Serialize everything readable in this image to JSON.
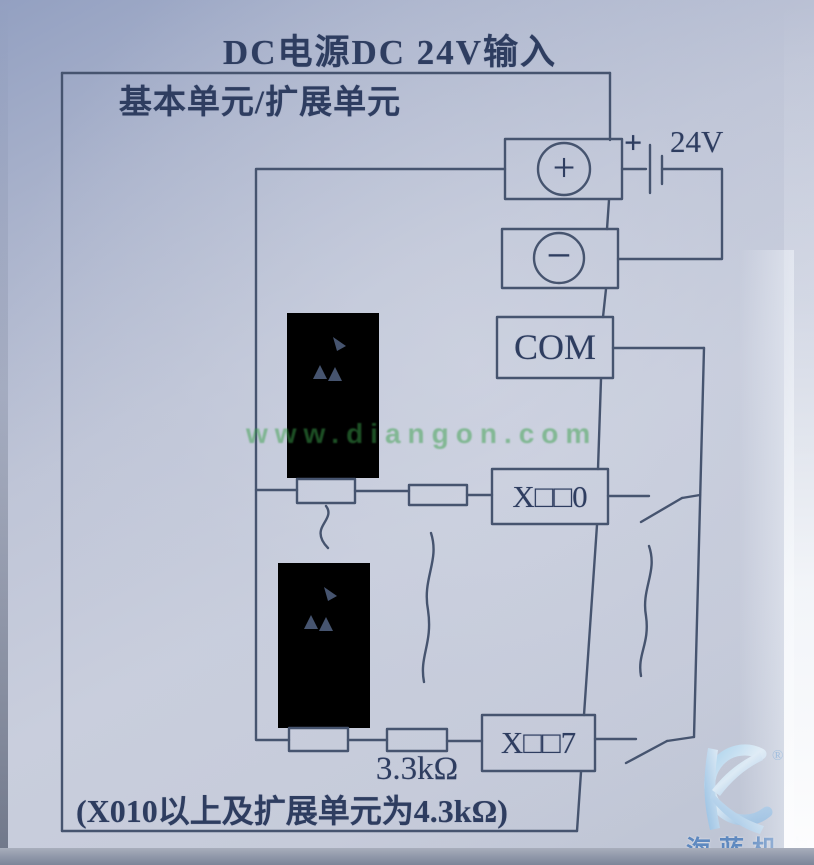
{
  "colors": {
    "line": "#46546f",
    "ink": "#2e3d60",
    "paper": "#c3c9da",
    "watermark_green": "#3aa04a",
    "logo_blue": "#3e73b5"
  },
  "header": {
    "title": "DC电源DC 24V输入",
    "unit_label": "基本单元/扩展单元"
  },
  "power": {
    "battery_plus": "+",
    "battery_voltage": "24V"
  },
  "terminals": {
    "plus": "+",
    "minus": "−",
    "com": "COM",
    "input_first": "X□□0",
    "input_last": "X□□7"
  },
  "labels": {
    "resistor_value": "3.3kΩ",
    "note": "(X010以上及扩展单元为4.3kΩ)"
  },
  "watermarks": {
    "site": "www.diangon.com",
    "logo_text": "海蓝机电",
    "registered_mark": "®"
  }
}
